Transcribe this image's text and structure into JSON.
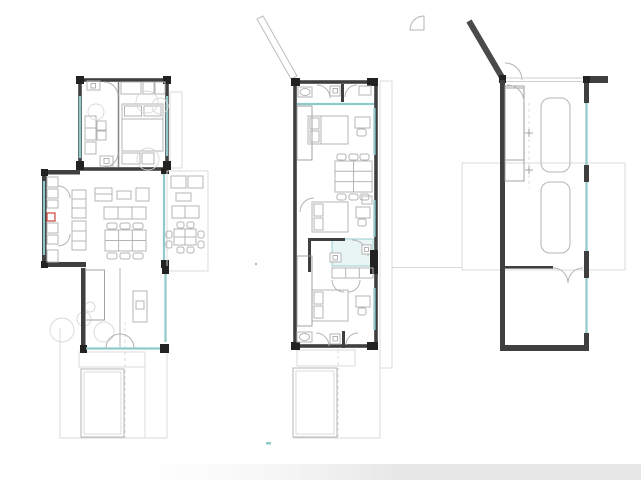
{
  "page": {
    "background": "#ffffff",
    "description": "Architectural drawing sheet showing three stacked house floor plans side by side"
  },
  "colors": {
    "wall": "#3f3f3f",
    "post": "#222222",
    "furniture": "#b4b4b4",
    "furniture_dark": "#9a9a9a",
    "faint": "#d8d8d8",
    "glazing": "#8fc9c9",
    "glazing_fill": "#e9f5f5",
    "hatch": "#c6c6c6",
    "stair": "#aaaaaa",
    "accent_red": "#cc4437",
    "shadow_band": "#e7e7e7"
  },
  "plans": [
    {
      "name": "left-plan-main-level",
      "features": [
        "master-bedroom",
        "bathroom",
        "kitchen",
        "living-dining",
        "terrace",
        "stairs",
        "steps",
        "pool",
        "trees"
      ]
    },
    {
      "name": "middle-plan-upper-level",
      "features": [
        "three-bedrooms",
        "two-bathrooms",
        "shower-room",
        "long-table",
        "stairs",
        "side-deck",
        "pool-outline"
      ]
    },
    {
      "name": "right-plan-entry-level",
      "features": [
        "angled-entry-wall",
        "staircase",
        "two-parking-spaces",
        "glazed-facade",
        "storage-room"
      ]
    }
  ],
  "counts": {
    "pools": 2,
    "cars": 2,
    "plans": 3
  }
}
